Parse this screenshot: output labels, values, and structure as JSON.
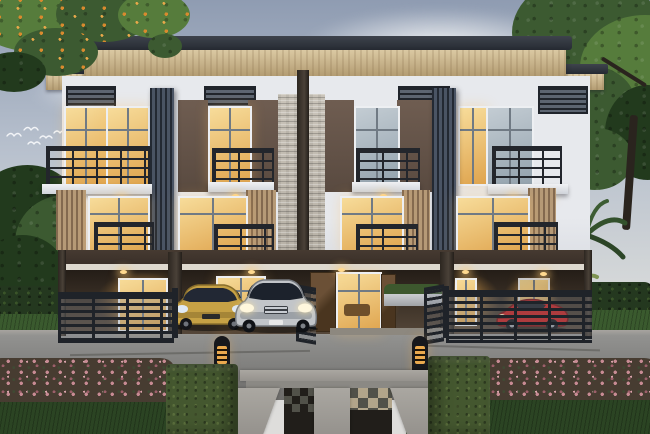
{
  "scene": {
    "description": "Dusk architectural rendering of a symmetric three-story modern townhouse row with warm-lit interiors, covered ground-floor parking with three cars, dark metal fences, landscaped front garden, stone paver walkway and two lit bollard lights",
    "time_of_day": "dusk",
    "building": {
      "floors": 3,
      "units": 4,
      "features": [
        "flat overhanging roof with wood soffit",
        "central stacked-stone accent strip with dark pillar",
        "dark vertical louver fins",
        "balconies with dark metal railings",
        "vertical wood louver screens",
        "parapet louver grilles",
        "recessed lit porches"
      ]
    },
    "vehicles": [
      {
        "name": "gold-sedan",
        "color": "#c6a145"
      },
      {
        "name": "silver-sedan",
        "color": "#c2c5c9"
      },
      {
        "name": "red-sports-car",
        "color": "#c41c1c"
      }
    ],
    "landscape": [
      "overhanging branch with orange blossoms top-left",
      "large green tree right",
      "palm fronds right of building",
      "trimmed hedge walls",
      "pink flowering shrub borders",
      "boxwood hedge cubes",
      "lawn",
      "concrete walkway with checker pavers and gravel"
    ],
    "birds_count": 5,
    "bollard_count": 2
  },
  "palette": {
    "sky-top": "#8f9cb2",
    "sky-mid": "#b7c0cd",
    "sky-low": "#d9dbda",
    "cloud": "#f3f4f5",
    "roof-dark": "#262b33",
    "roof-dark2": "#3e434c",
    "soffit": "#dbc9a3",
    "soffit-shade": "#b39c72",
    "facade": "#e7e9ed",
    "facade-shade": "#c9cdd5",
    "panel": "#6f5d51",
    "panel-dark": "#594a40",
    "band": "#392f28",
    "stone": "#c9c3b9",
    "pillar-c": "#3a332c",
    "fin": "#232933",
    "fin-hi": "#4a5464",
    "grille": "#5d6571",
    "grille-slat": "#20242b",
    "railc": "#23262c",
    "wood": "#b69a77",
    "wood-dark": "#83694f",
    "win-warm1": "#f7dc9a",
    "win-warm2": "#dfa44e",
    "win-dim1": "#c3ccd3",
    "win-dim2": "#93a2ad",
    "frame": "#edeff2",
    "mullion": "#707a84",
    "interior": "#2e251d",
    "door-wood": "#5f4730",
    "light": "#ffd98f",
    "fence": "#1f2329",
    "planter-c": "#cbced2",
    "shrub": "#3d582e",
    "drive1": "#929290",
    "drive2": "#6d6c6a",
    "curb": "#a7a49f",
    "lawn": "#2b4423",
    "hedge": "#24381f",
    "hedge-lite": "#3a5429",
    "cube": "#44572f",
    "cube-hi": "#5a6e3c",
    "pink": "#c88b94",
    "pink-deep": "#9c5f6a",
    "pinkleaf": "#473c31",
    "tan": "#b2a58a",
    "pdark": "#515149",
    "gravel": "#211e1a",
    "conc": "#95928d",
    "conc-hi": "#aaa7a1",
    "bollard-c": "#17181c",
    "amber": "#eaa94e",
    "car-gold": "#c6a145",
    "car-gold-d": "#8a6f2c",
    "car-silver": "#c2c5c9",
    "car-silver-d": "#75797f",
    "car-red": "#c41c1c",
    "car-red-d": "#700d0e",
    "glass": "#1b202a",
    "treeg": "#3c5a31",
    "treeg-hi": "#567c3c",
    "treeg-dk": "#223a1d",
    "orange": "#d98a2e",
    "trunk": "#2a241e",
    "palm": "#7e9352"
  }
}
